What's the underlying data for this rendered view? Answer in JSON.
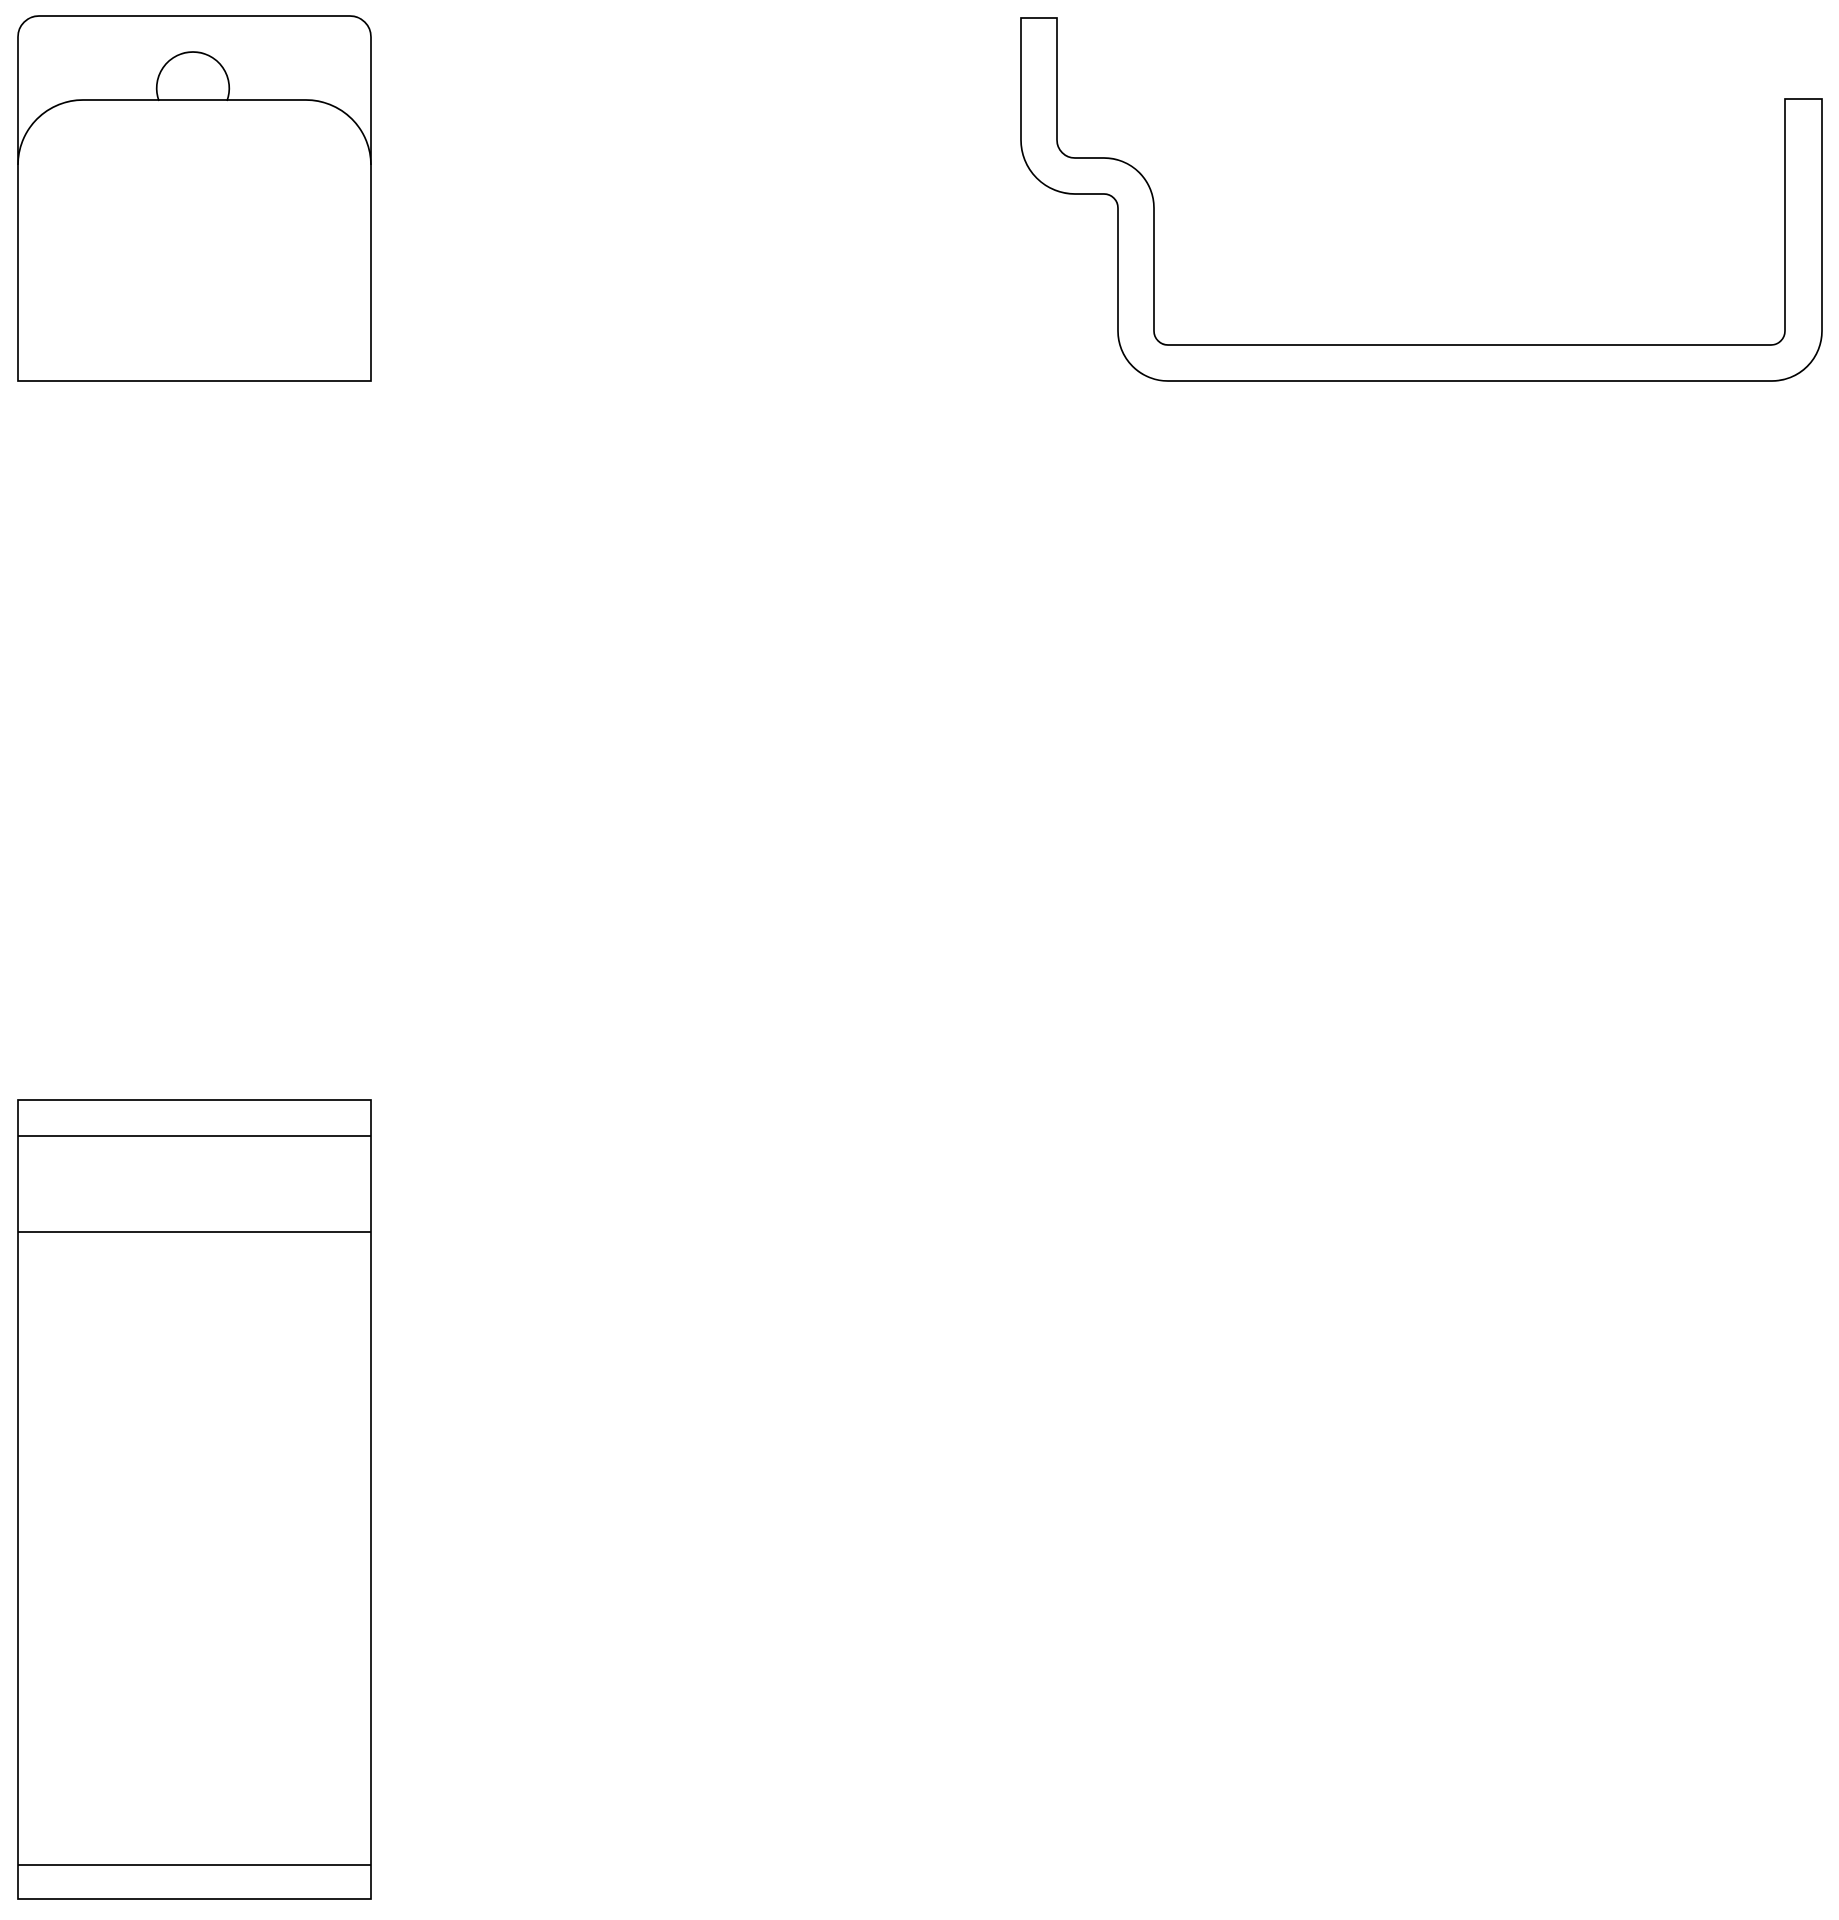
{
  "canvas": {
    "width": 1839,
    "height": 1920,
    "background": "#ffffff"
  },
  "drawing": {
    "stroke": {
      "color": "#000000",
      "width": 1.7
    },
    "figures": [
      {
        "name": "hang-tab-front-view",
        "paths": [
          {
            "name": "pad-outline",
            "d": "M 18 381 L 18 37 A 21 21 0 0 1 39 16 L 350 16 A 21 21 0 0 1 371 37 L 371 381 Z"
          },
          {
            "name": "flap-fold-line",
            "d": "M 18 165 A 65 65 0 0 1 83 100 L 306 100 A 65 65 0 0 1 371 165"
          },
          {
            "name": "notch-arc",
            "d": "M 159 101 A 36.3 36.3 0 1 1 227 101"
          }
        ]
      },
      {
        "name": "bracket-profile-view",
        "paths": [
          {
            "name": "profile-outline",
            "d": "M 1021 18 L 1057 18 L 1057 140 A 18 18 0 0 0 1075 158 L 1104 158 A 50 50 0 0 1 1154 208 L 1154 331 A 14 14 0 0 0 1168 345 L 1771 345 A 14 14 0 0 0 1785 331 L 1785 99 L 1822 99 L 1822 331 A 50 50 0 0 1 1772 381 L 1168 381 A 50 50 0 0 1 1118 331 L 1118 208 A 14 14 0 0 0 1104 194 L 1075 194 A 54 54 0 0 1 1021 140 Z"
          }
        ]
      },
      {
        "name": "plate-side-view",
        "paths": [
          {
            "name": "plate-outline",
            "d": "M 18 1100 L 371 1100 L 371 1899 L 18 1899 Z"
          },
          {
            "name": "seam-line-top",
            "d": "M 18 1136 L 371 1136"
          },
          {
            "name": "seam-line-upper",
            "d": "M 18 1232 L 371 1232"
          },
          {
            "name": "seam-line-bottom",
            "d": "M 18 1865 L 371 1865"
          }
        ]
      }
    ]
  }
}
